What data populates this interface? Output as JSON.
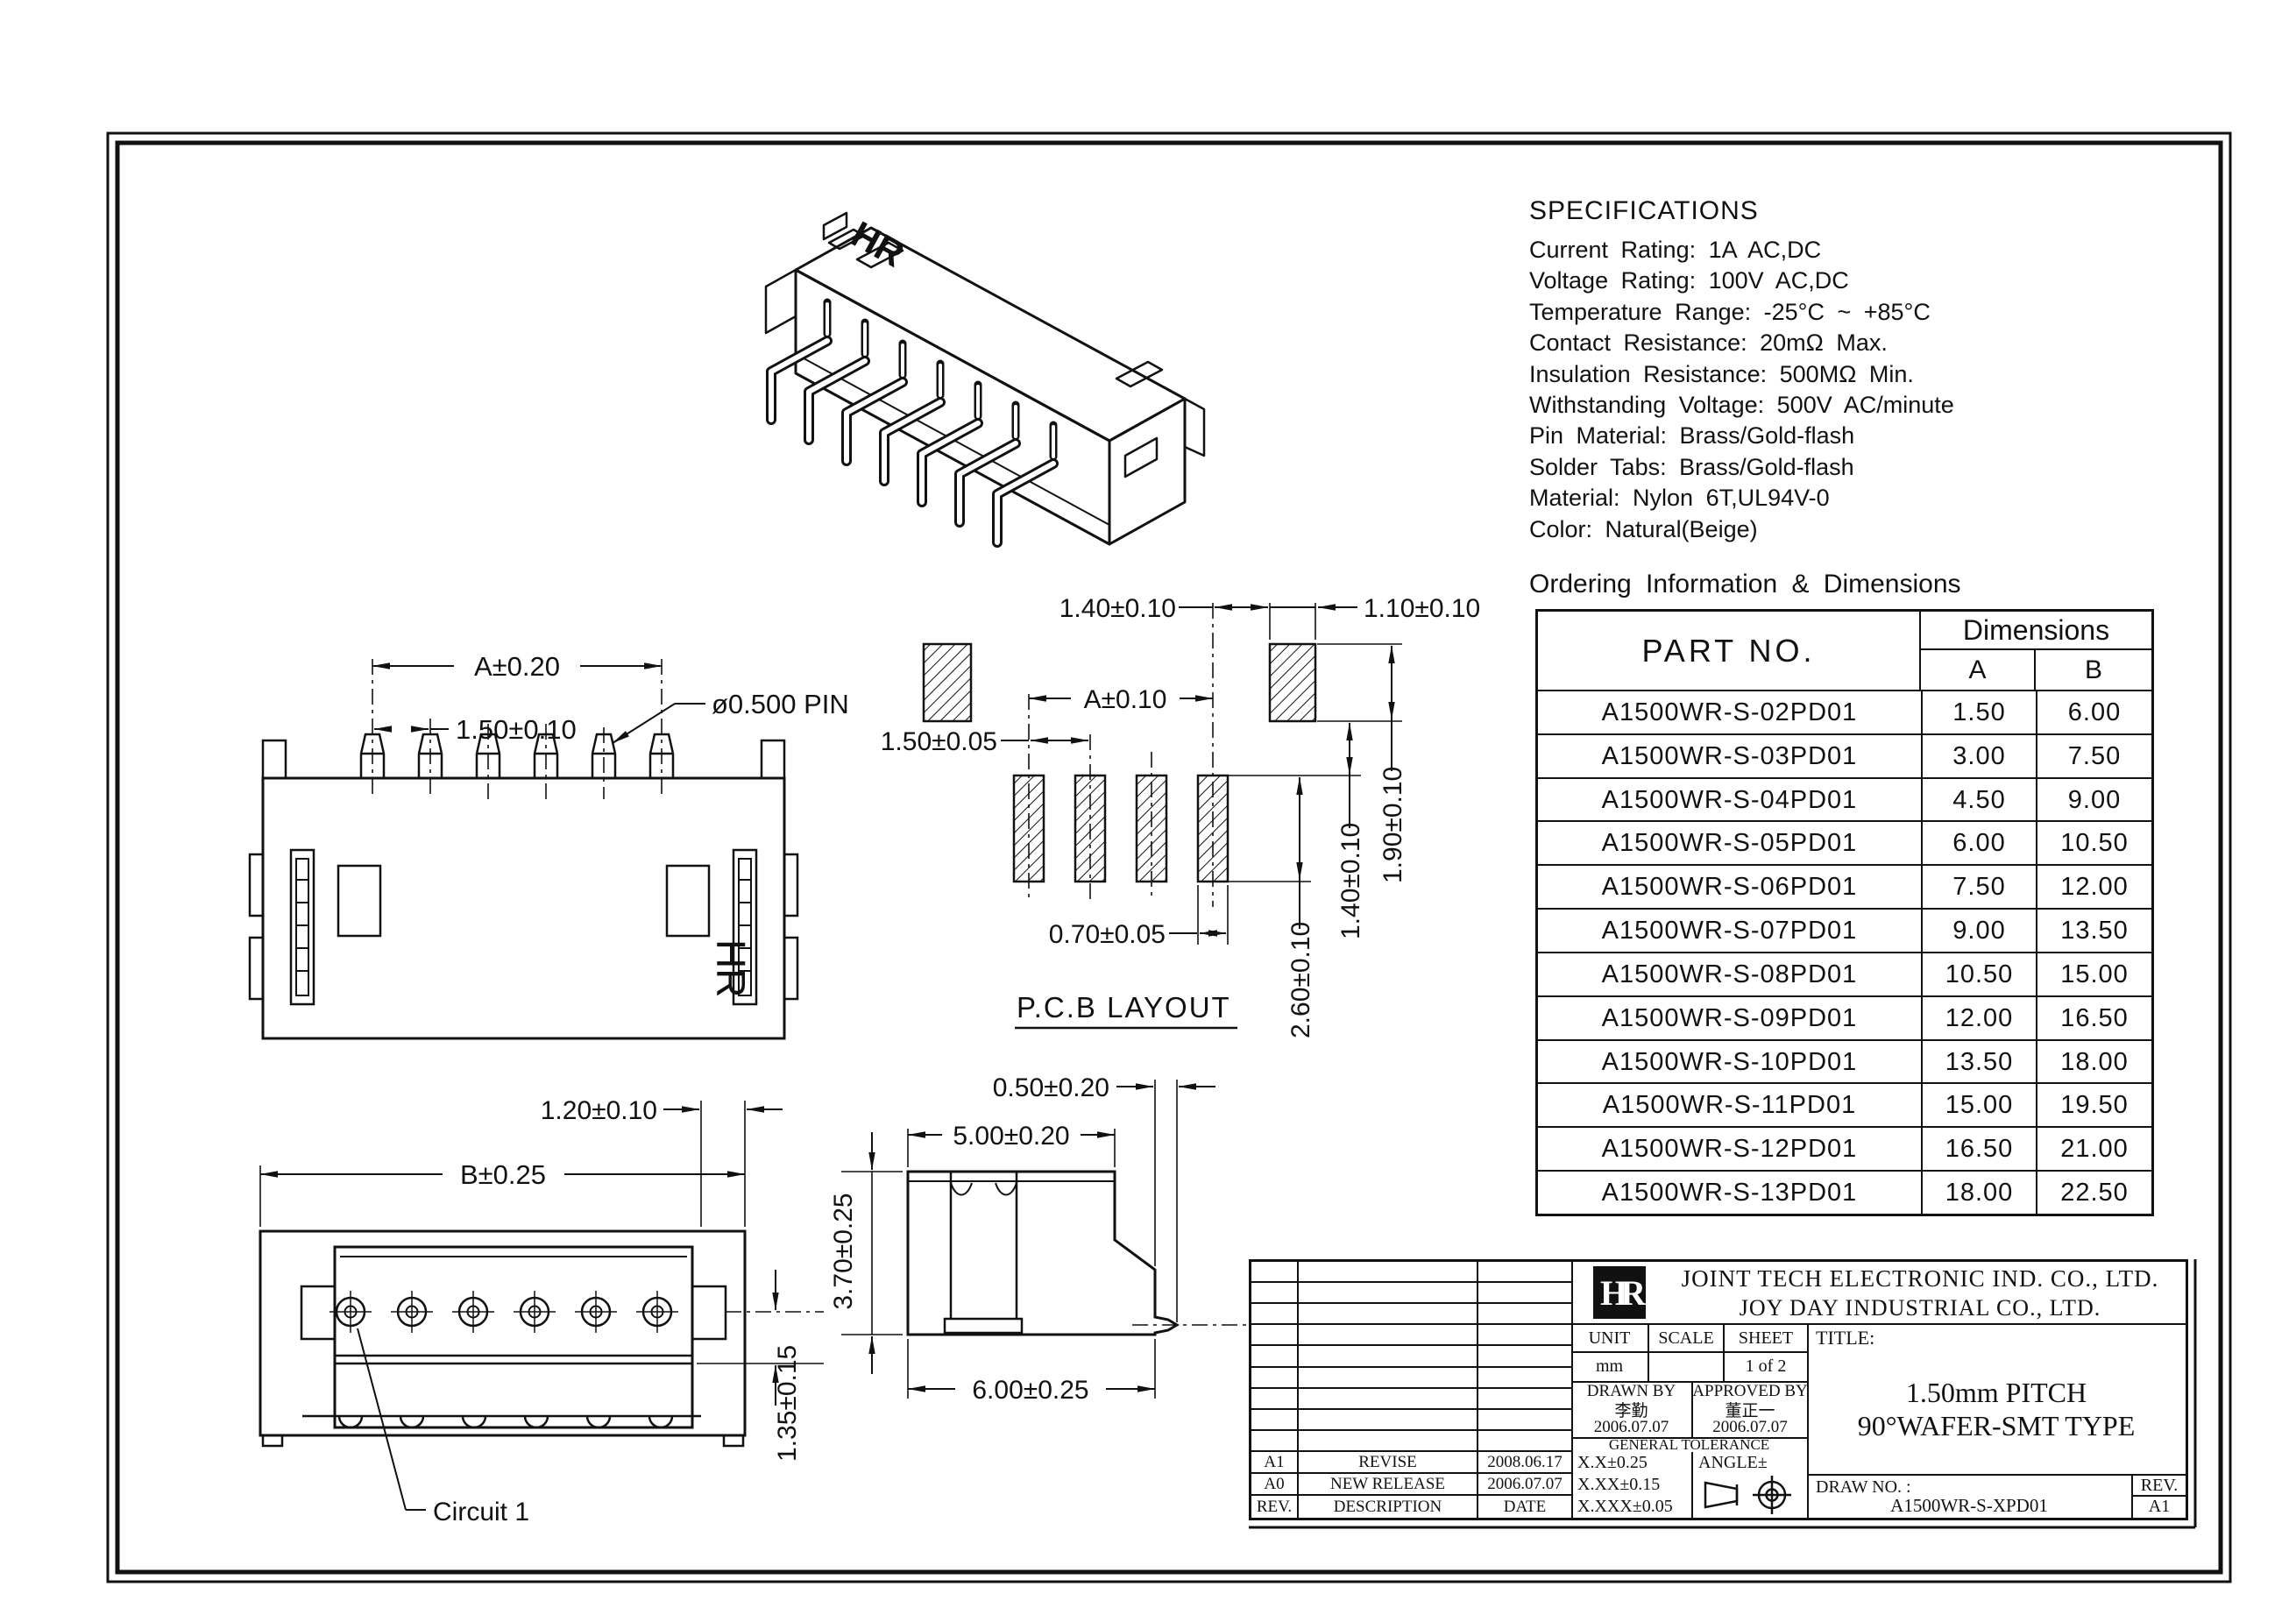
{
  "specs": {
    "title": "SPECIFICATIONS",
    "lines": [
      "Current Rating: 1A AC,DC",
      "Voltage Rating: 100V AC,DC",
      "Temperature Range: -25°C ~ +85°C",
      "Contact Resistance: 20mΩ Max.",
      "Insulation Resistance: 500MΩ Min.",
      "Withstanding Voltage: 500V AC/minute",
      "Pin Material: Brass/Gold-flash",
      "Solder Tabs: Brass/Gold-flash",
      "Material: Nylon 6T,UL94V-0",
      "Color: Natural(Beige)"
    ]
  },
  "ordering": {
    "heading": "Ordering Information & Dimensions",
    "table": {
      "part_header": "PART NO.",
      "dims_header": "Dimensions",
      "col_a": "A",
      "col_b": "B",
      "rows": [
        {
          "part": "A1500WR-S-02PD01",
          "a": "1.50",
          "b": "6.00"
        },
        {
          "part": "A1500WR-S-03PD01",
          "a": "3.00",
          "b": "7.50"
        },
        {
          "part": "A1500WR-S-04PD01",
          "a": "4.50",
          "b": "9.00"
        },
        {
          "part": "A1500WR-S-05PD01",
          "a": "6.00",
          "b": "10.50"
        },
        {
          "part": "A1500WR-S-06PD01",
          "a": "7.50",
          "b": "12.00"
        },
        {
          "part": "A1500WR-S-07PD01",
          "a": "9.00",
          "b": "13.50"
        },
        {
          "part": "A1500WR-S-08PD01",
          "a": "10.50",
          "b": "15.00"
        },
        {
          "part": "A1500WR-S-09PD01",
          "a": "12.00",
          "b": "16.50"
        },
        {
          "part": "A1500WR-S-10PD01",
          "a": "13.50",
          "b": "18.00"
        },
        {
          "part": "A1500WR-S-11PD01",
          "a": "15.00",
          "b": "19.50"
        },
        {
          "part": "A1500WR-S-12PD01",
          "a": "16.50",
          "b": "21.00"
        },
        {
          "part": "A1500WR-S-13PD01",
          "a": "18.00",
          "b": "22.50"
        }
      ]
    }
  },
  "views": {
    "isometric": {
      "brand_mark": "HR"
    },
    "top": {
      "dim_a": "A±0.20",
      "dim_pitch": "1.50±0.10",
      "pin_label": "ø0.500 PIN",
      "brand_mark": "HR"
    },
    "pcb": {
      "label": "P.C.B LAYOUT",
      "dim_140_top": "1.40±0.10",
      "dim_110": "1.10±0.10",
      "dim_a": "A±0.10",
      "dim_150": "1.50±0.05",
      "dim_070": "0.70±0.05",
      "dim_260": "2.60±0.10",
      "dim_140_side": "1.40±0.10",
      "dim_190": "1.90±0.10"
    },
    "front": {
      "dim_120": "1.20±0.10",
      "dim_b": "B±0.25",
      "dim_135": "1.35±0.15",
      "circuit_label": "Circuit 1"
    },
    "side": {
      "dim_050": "0.50±0.20",
      "dim_500": "5.00±0.20",
      "dim_370": "3.70±0.25",
      "dim_600": "6.00±0.25"
    }
  },
  "title_block": {
    "logo_text": "HR",
    "company_line1": "JOINT TECH ELECTRONIC IND. CO., LTD.",
    "company_line2": "JOY DAY INDUSTRIAL CO., LTD.",
    "unit_label": "UNIT",
    "unit_value": "mm",
    "scale_label": "SCALE",
    "scale_value": "",
    "sheet_label": "SHEET",
    "sheet_value": "1 of 2",
    "title_label": "TITLE:",
    "title_line1": "1.50mm PITCH",
    "title_line2": "90°WAFER-SMT TYPE",
    "drawn_by_label": "DRAWN BY",
    "drawn_by_sign": "李勤",
    "drawn_by_date": "2006.07.07",
    "approved_by_label": "APPROVED BY",
    "approved_by_sign": "董正一",
    "approved_by_date": "2006.07.07",
    "general_tolerance": "GENERAL TOLERANCE",
    "tol1": "X.X±0.25",
    "tol2": "X.XX±0.15",
    "tol3": "X.XXX±0.05",
    "angle_label": "ANGLE±",
    "draw_no_label": "DRAW NO. :",
    "draw_no_value": "A1500WR-S-XPD01",
    "rev_label": "REV.",
    "rev_value": "A1",
    "revisions": {
      "header": {
        "rev": "REV.",
        "description": "DESCRIPTION",
        "date": "DATE"
      },
      "rows": [
        {
          "rev": "A1",
          "description": "REVISE",
          "date": "2008.06.17"
        },
        {
          "rev": "A0",
          "description": "NEW RELEASE",
          "date": "2006.07.07"
        }
      ]
    }
  }
}
